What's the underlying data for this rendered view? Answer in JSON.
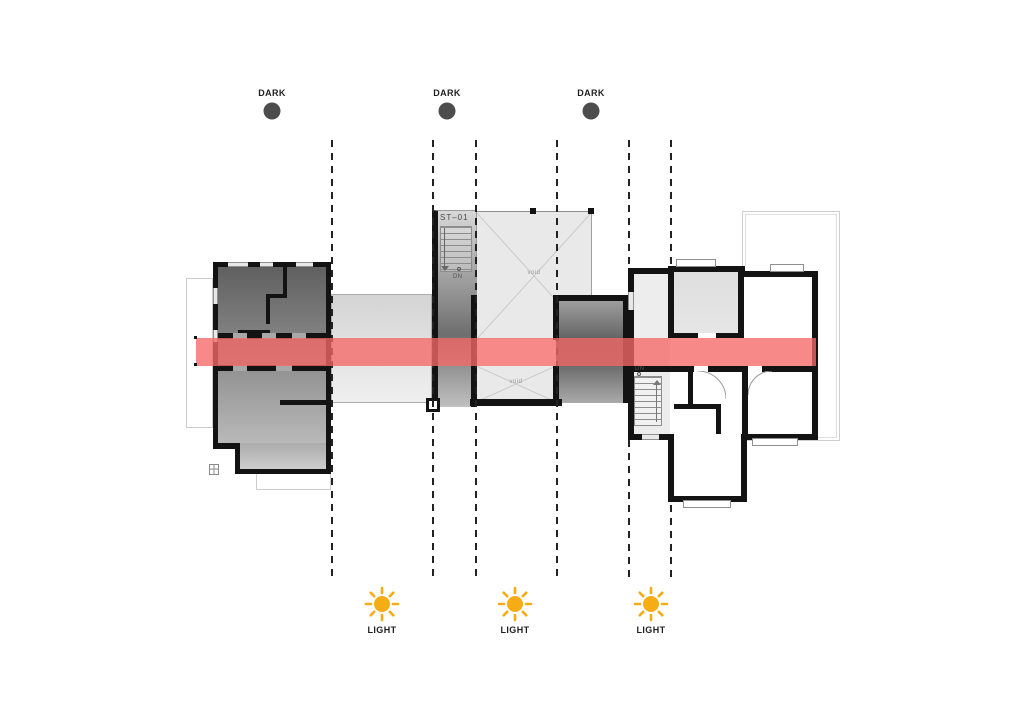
{
  "annotations": {
    "top": [
      {
        "label": "DARK"
      },
      {
        "label": "DARK"
      },
      {
        "label": "DARK"
      }
    ],
    "bottom": [
      {
        "label": "LIGHT"
      },
      {
        "label": "LIGHT"
      },
      {
        "label": "LIGHT"
      }
    ]
  },
  "plan": {
    "stair_core_label": "ST–01",
    "stair_core_dn": "DN",
    "stair_bay_dn": "DN",
    "void_upper_label": "void",
    "void_lower_label": "void"
  },
  "colors": {
    "background": "#FFFFFF",
    "dark_marker": "#4D4D4D",
    "sun": "#F6AC15",
    "section_band": "#F86868",
    "wall": "#131313",
    "dashed_line": "#222222"
  }
}
